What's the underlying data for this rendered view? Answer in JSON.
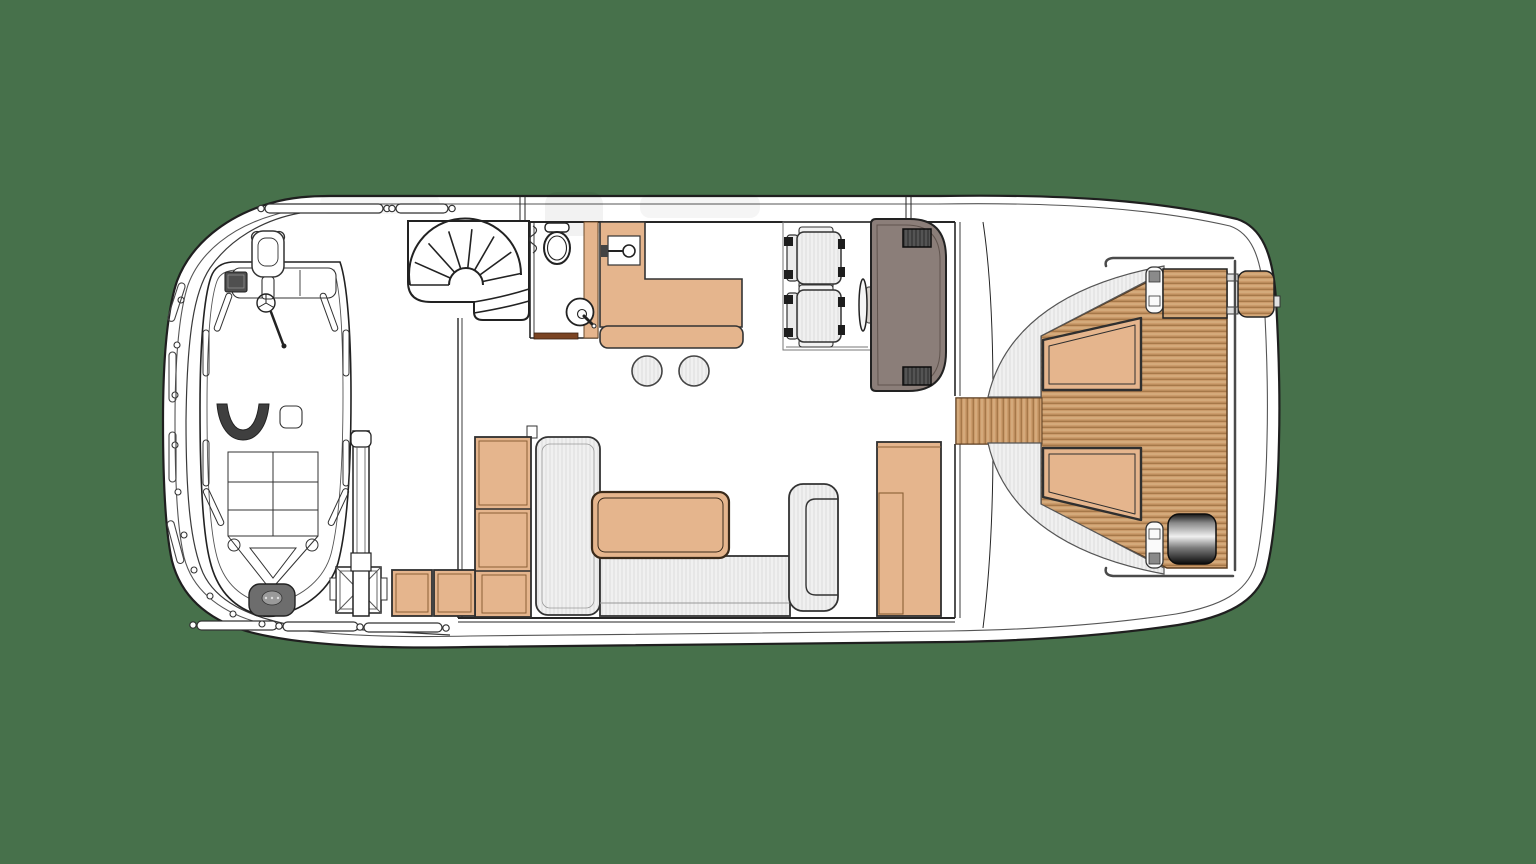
{
  "image_type": "motor-yacht deck floor plan, top view line drawing",
  "visible_text": [],
  "colors": {
    "background": "#47714b",
    "outline": "#1f1f1f",
    "hull": "#ffffff",
    "wood_tan": "#e5b58d",
    "wood_tan_border": "#6b4a2a",
    "teak_base": "#cb9b6b",
    "teak_stripe": "#96683a",
    "teak_highlight": "#e3bf93",
    "upholstery": "#f0f0f0",
    "upholstery_stripe": "#d9d9d9",
    "console": "#8b7e79",
    "vent": "#3f3f3f",
    "vent_stripe": "#6a6a6a",
    "threshold": "#7a4423",
    "tender_pad": "#6d6d6d",
    "tender_console": "#4f4f4f",
    "metal_dark": "#151515",
    "metal_mid": "#8a8a8a",
    "metal_light": "#f0f0f0"
  },
  "components": {
    "hull": "yacht hull outline",
    "tender": "tender boat stowed on deck",
    "crane": "tender launching crane with base",
    "staircase": "spiral staircase",
    "head": "toilet room with WC and round basin",
    "galley": "L-shaped galley counter with sink",
    "stools": "two round stools",
    "helm": "twin helm seats, steering wheel and console",
    "sofa": "L-shaped sofa with chaise and armrest",
    "table": "rectangular table",
    "cabinets": "storage cabinet units",
    "sunpad": "curved upholstered sun-lounger backrest",
    "cushions": "two tan sunpad cushions",
    "teak_deck": "teak planked aft deck",
    "grill": "stainless steel cylinder unit",
    "platform": "hinged teak boarding platform",
    "railings": "deck handrails and stanchions"
  }
}
